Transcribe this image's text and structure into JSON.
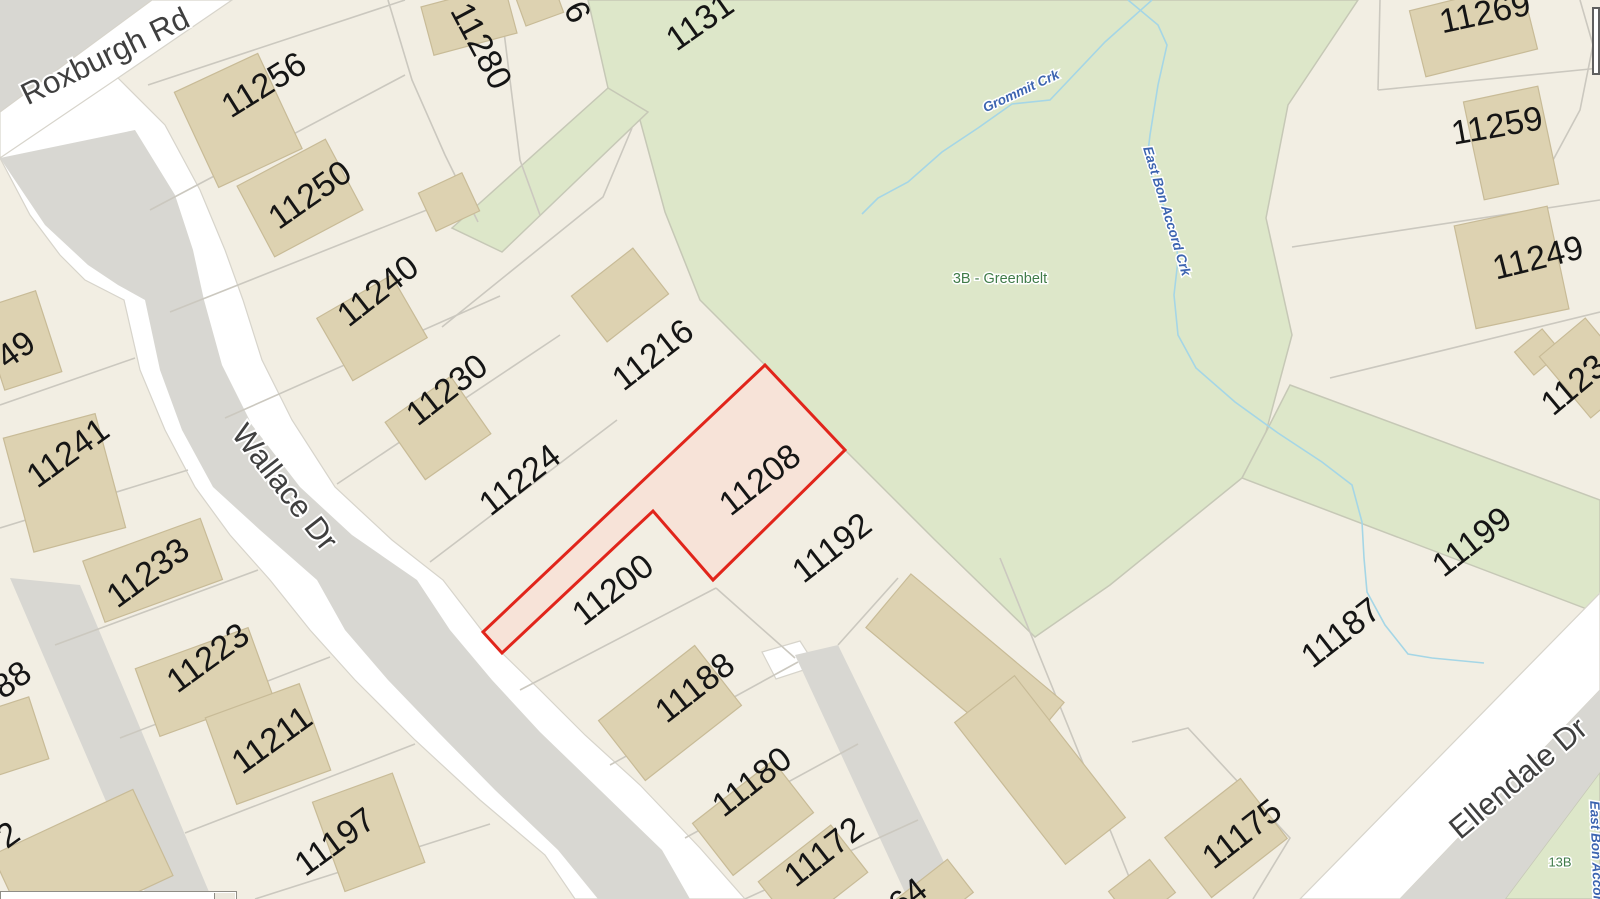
{
  "map_view": {
    "description": "Parcel / assessment map with highlighted lot",
    "highlighted_parcel": {
      "number": "11208",
      "outline_color": "#e1251b",
      "fill_color": "#f7e3d8"
    },
    "parcel_labels": [
      {
        "text": "11256"
      },
      {
        "text": "11250"
      },
      {
        "text": "11240"
      },
      {
        "text": "11230"
      },
      {
        "text": "11224"
      },
      {
        "text": "11216"
      },
      {
        "text": "11208",
        "highlighted": true
      },
      {
        "text": "11200"
      },
      {
        "text": "11192"
      },
      {
        "text": "11188"
      },
      {
        "text": "11180"
      },
      {
        "text": "11172"
      },
      {
        "text": "11280"
      },
      {
        "text": "11241"
      },
      {
        "text": "11233"
      },
      {
        "text": "11223"
      },
      {
        "text": "11211"
      },
      {
        "text": "11197"
      },
      {
        "text": "11269"
      },
      {
        "text": "11259"
      },
      {
        "text": "11249"
      },
      {
        "text": "11199"
      },
      {
        "text": "11187"
      },
      {
        "text": "11175"
      }
    ],
    "partial_parcel_labels": [
      {
        "text": "49"
      },
      {
        "text": "88"
      },
      {
        "text": "2"
      },
      {
        "text": "6"
      },
      {
        "text": "1131"
      },
      {
        "text": "1123"
      },
      {
        "text": "64"
      }
    ],
    "streets": [
      {
        "name": "Roxburgh Rd"
      },
      {
        "name": "Wallace Dr"
      },
      {
        "name": "Ellendale Dr"
      }
    ],
    "creeks": [
      {
        "name": "Grommit Crk"
      },
      {
        "name": "East Bon Accord Crk"
      }
    ],
    "zones": [
      {
        "label": "3B - Greenbelt"
      },
      {
        "label": "13B"
      }
    ],
    "colors": {
      "parcel_fill": "#f2eee3",
      "road_fill": "#d8d7d2",
      "road_right_of_way": "#ffffff",
      "greenbelt_fill": "#dde7c9",
      "building_fill": "#ddd2b1",
      "boundary_line": "#cbc8bf",
      "creek_stroke": "#a5d6e6",
      "creek_label": "#3c64b0",
      "zone_label": "#3f7b48",
      "street_label": "#3f3f3f",
      "parcel_label": "#151515"
    }
  },
  "ui": {
    "horizontal_scrollbar": {
      "visible": true
    },
    "corner_panel_fragment": {
      "visible": true
    }
  }
}
